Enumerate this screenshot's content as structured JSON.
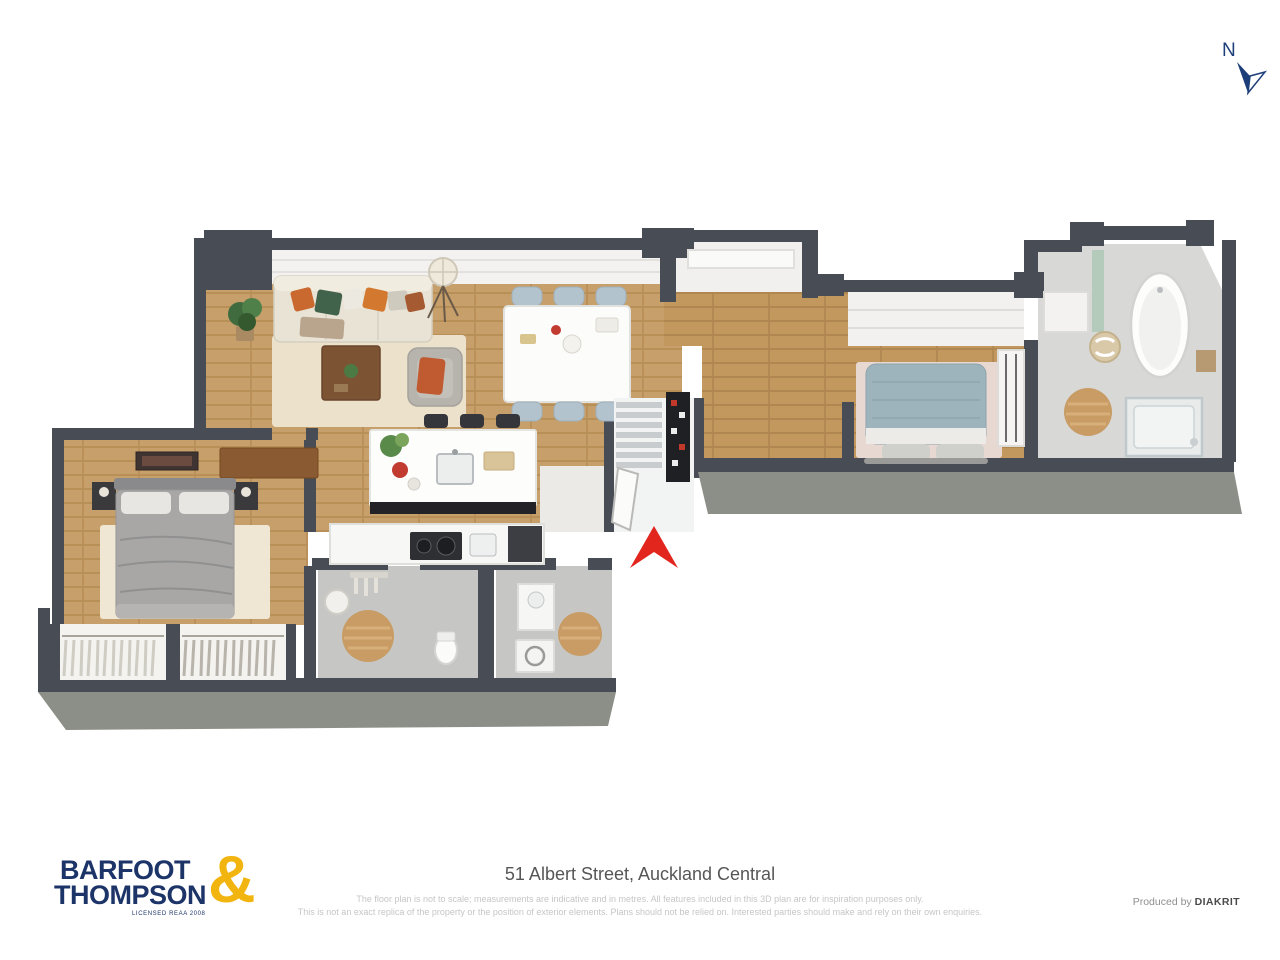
{
  "compass": {
    "label": "N",
    "color": "#1d3e78"
  },
  "floorplan": {
    "entrance_arrow_color": "#e2261e",
    "palette": {
      "wall": "#484c55",
      "wall_front_face": "#8c8f87",
      "wood_floor": "#c79f6a",
      "tile_floor": "#c6c7c5",
      "bath_tile_floor": "#d8d9d7",
      "rug_cream": "#ece2cc",
      "rug_pink": "#e8d8d2",
      "bed_gray": "#a8a7a6",
      "bed_blue": "#9db4bd",
      "sofa_cream": "#e9e3d6",
      "dining_chair_blue": "#b3c3cd",
      "island_base_dark": "#232327",
      "bath_mat_tan": "#c89c64"
    }
  },
  "footer": {
    "logo": {
      "line1": "BARFOOT",
      "line2": "THOMPSON",
      "ampersand": "&",
      "license": "LICENSED REAA 2008",
      "navy": "#1c3468",
      "gold": "#f2b40e"
    },
    "address": "51 Albert Street, Auckland Central",
    "disclaimer_line1": "The floor plan is not to scale; measurements are indicative and in metres. All features included in this 3D plan are for inspiration purposes only.",
    "disclaimer_line2": "This is not an exact replica of the property or the position of exterior elements. Plans should not be relied on. Interested parties should make and rely on their own enquiries.",
    "produced_by_prefix": "Produced by",
    "produced_by_name": "DIAKRIT"
  }
}
